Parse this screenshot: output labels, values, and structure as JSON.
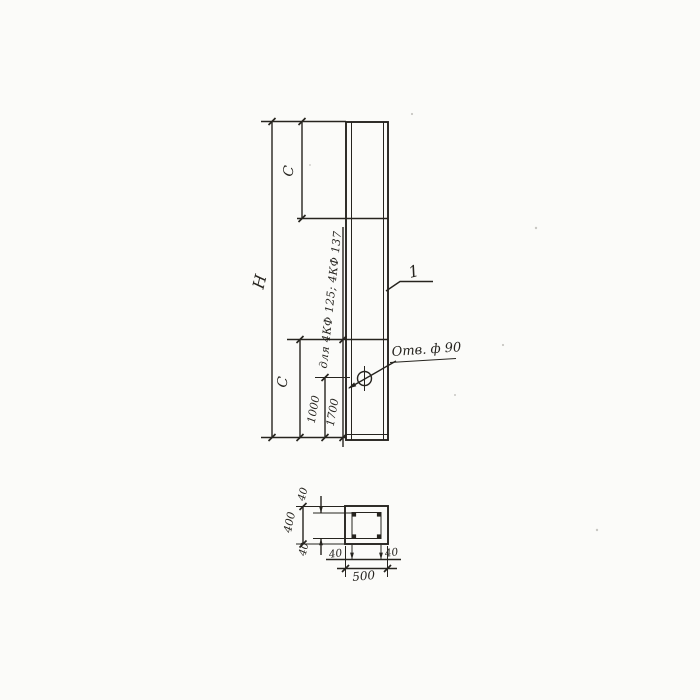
{
  "page": {
    "paper_color": "#fbfbf9",
    "ink_color": "#26241f"
  },
  "elevation": {
    "height_label": "Н",
    "top_segment_label": "С",
    "bottom_segment_label": "С",
    "hole_distance_main": "1000",
    "hole_distance_alt": "1700",
    "alt_note": "для 4КФ 125; 4КФ 137",
    "hole_note": "Отв. ф 90",
    "position_mark": "1"
  },
  "section": {
    "overall_width": "500",
    "overall_height": "400",
    "cover_top": "40",
    "cover_bottom": "40",
    "cover_left": "40",
    "cover_right": "40"
  }
}
